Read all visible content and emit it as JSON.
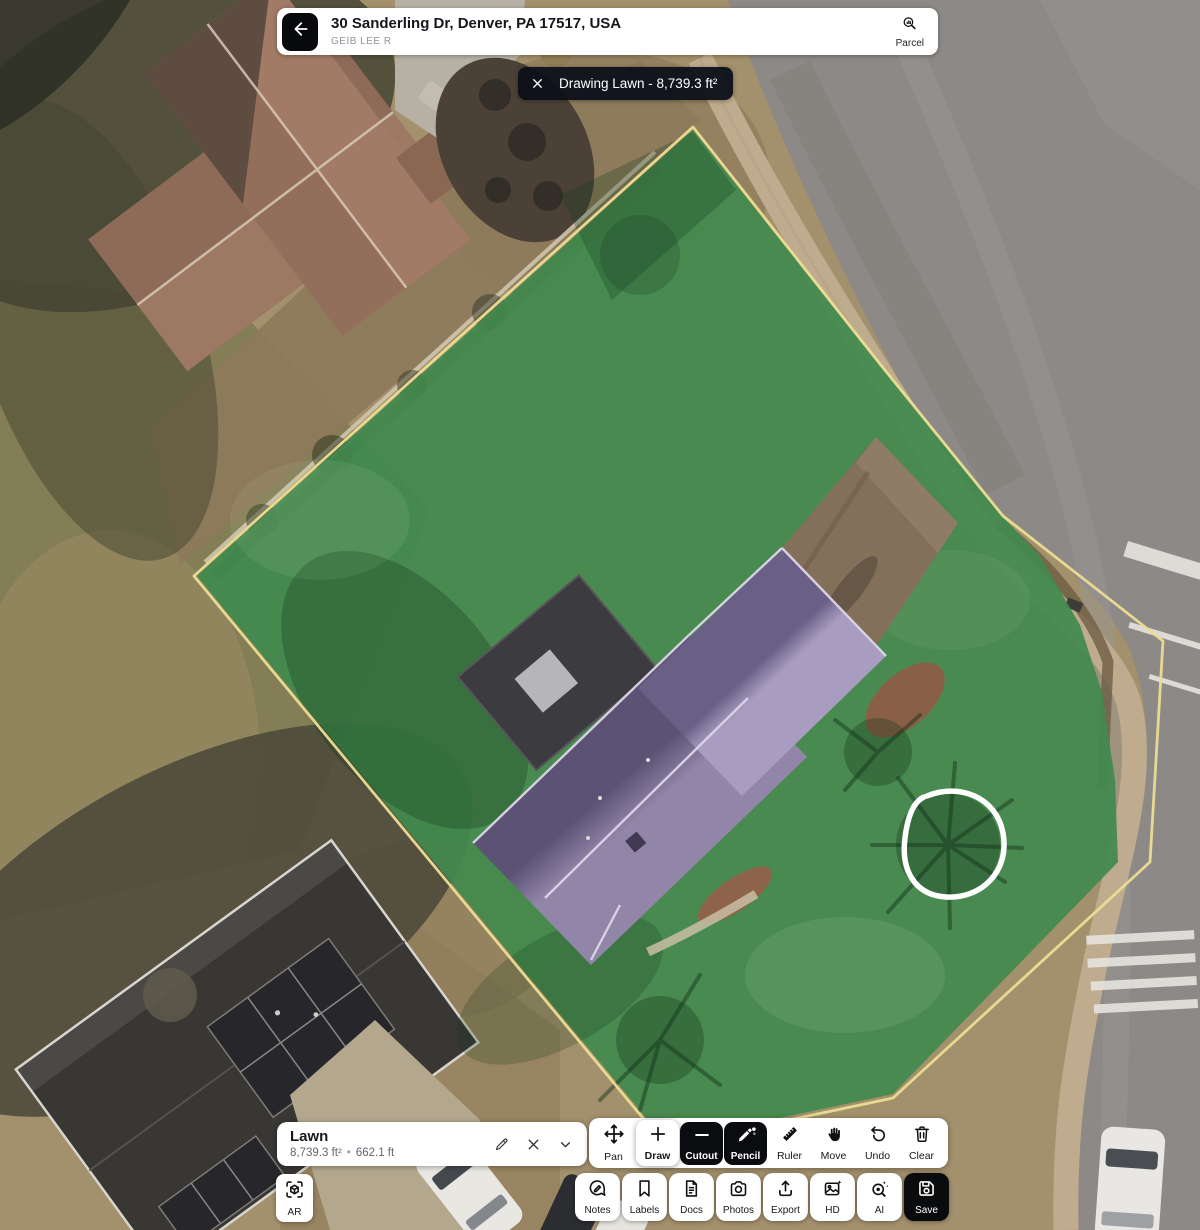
{
  "header": {
    "title": "30 Sanderling Dr, Denver, PA 17517, USA",
    "subtitle": "GEIB LEE R",
    "parcel_button": {
      "label": "Parcel",
      "icon": "parcel-search-icon"
    }
  },
  "drawing_banner": {
    "label": "Drawing Lawn - 8,739.3 ft²",
    "close_icon": "close-icon"
  },
  "measurement_panel": {
    "title": "Lawn",
    "area": "8,739.3 ft²",
    "bullet": "•",
    "perimeter": "662.1 ft",
    "action_icons": [
      "edit-pencil-icon",
      "delete-x-icon",
      "collapse-chevron-icon"
    ]
  },
  "toolbar": {
    "tools": [
      {
        "id": "pan",
        "label": "Pan",
        "icon": "pan-arrows-icon",
        "state": "normal"
      },
      {
        "id": "draw",
        "label": "Draw",
        "icon": "plus-icon",
        "state": "selected"
      },
      {
        "id": "cutout",
        "label": "Cutout",
        "icon": "minus-icon",
        "state": "dark"
      },
      {
        "id": "pencil",
        "label": "Pencil",
        "icon": "pencil-icon",
        "state": "dark"
      },
      {
        "id": "ruler",
        "label": "Ruler",
        "icon": "ruler-icon",
        "state": "normal"
      },
      {
        "id": "move",
        "label": "Move",
        "icon": "hand-icon",
        "state": "normal"
      },
      {
        "id": "undo",
        "label": "Undo",
        "icon": "undo-icon",
        "state": "normal"
      },
      {
        "id": "clear",
        "label": "Clear",
        "icon": "trash-icon",
        "state": "normal"
      }
    ]
  },
  "ar_button": {
    "label": "AR",
    "icon": "ar-scan-icon"
  },
  "bottom_bar": {
    "buttons": [
      {
        "id": "notes",
        "label": "Notes",
        "icon": "chat-pencil-icon",
        "style": "light"
      },
      {
        "id": "labels",
        "label": "Labels",
        "icon": "bookmark-icon",
        "style": "light"
      },
      {
        "id": "docs",
        "label": "Docs",
        "icon": "document-icon",
        "style": "light"
      },
      {
        "id": "photos",
        "label": "Photos",
        "icon": "camera-icon",
        "style": "light"
      },
      {
        "id": "export",
        "label": "Export",
        "icon": "upload-icon",
        "style": "light"
      },
      {
        "id": "hd",
        "label": "HD",
        "icon": "image-sparkle-icon",
        "style": "light"
      },
      {
        "id": "ai",
        "label": "AI",
        "icon": "magnifier-sparkle-icon",
        "style": "light"
      },
      {
        "id": "save",
        "label": "Save",
        "icon": "floppy-icon",
        "style": "dark"
      }
    ]
  },
  "map": {
    "overlay_colors": {
      "lawn_fill": "#428A4D",
      "roof_overlay_dark": "#5B5274",
      "roof_overlay_light": "#9185A8",
      "parcel_boundary": "#ECDD92",
      "annotation_circle": "#FFFFFF"
    }
  }
}
